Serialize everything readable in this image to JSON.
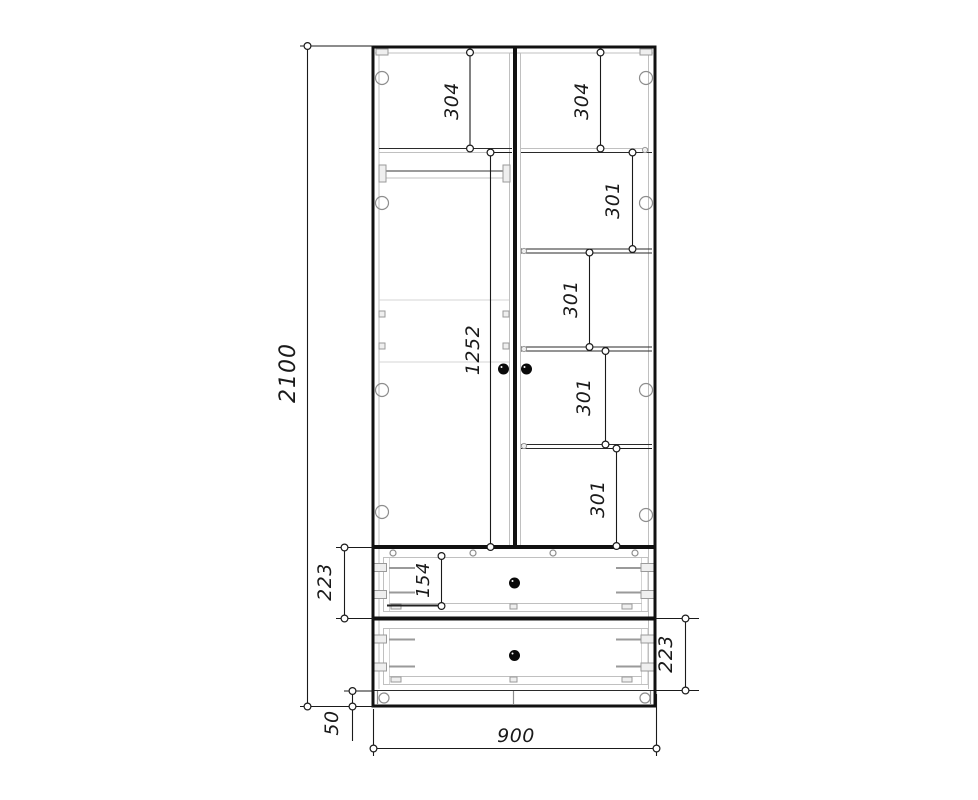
{
  "drawing": {
    "kind": "wardrobe-front-elevation-technical-drawing",
    "colors": {
      "line": "#1a1a1a",
      "light_line": "#c0c0c0",
      "background": "#ffffff"
    },
    "dims": {
      "total_height": "2100",
      "total_width": "900",
      "plinth_height": "50",
      "door_height": "1252",
      "left_top_section": "304",
      "right_top_section": "304",
      "right_shelf_1": "301",
      "right_shelf_2": "301",
      "right_shelf_3": "301",
      "right_shelf_4": "301",
      "upper_drawer_height": "223",
      "lower_drawer_height": "223",
      "drawer_box_height": "154"
    }
  }
}
